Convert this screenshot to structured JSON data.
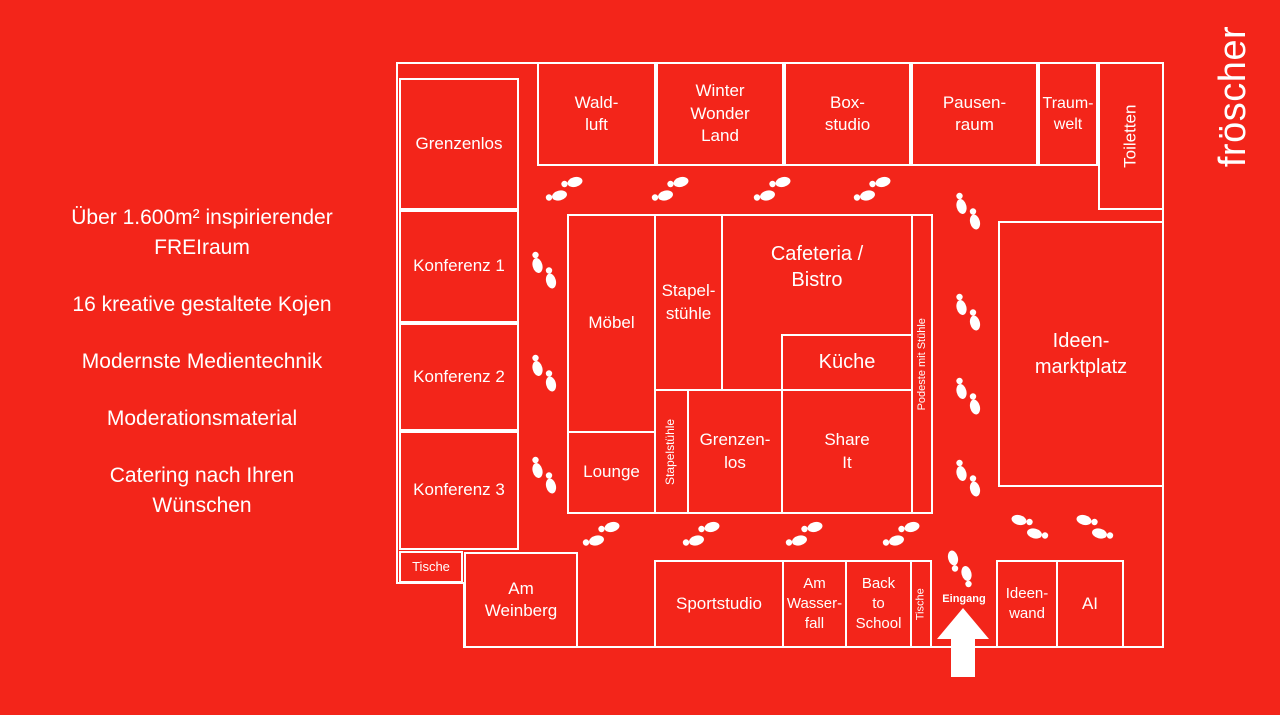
{
  "colors": {
    "background": "#F3251A",
    "line": "#FFFFFF",
    "text": "#FFFFFF"
  },
  "brand": {
    "logo": "fröscher"
  },
  "info_panel": {
    "paragraphs": [
      "Über 1.600m² inspirierender\nFREIraum",
      "16 kreative gestaltete Kojen",
      "Modernste Medientechnik",
      "Moderationsmaterial",
      "Catering nach Ihren\nWünschen"
    ]
  },
  "floorplan": {
    "entrance_label": "Eingang",
    "rooms": [
      {
        "id": "waldluft",
        "label": "Wald-\nluft"
      },
      {
        "id": "winterwonderland",
        "label": "Winter\nWonder\nLand"
      },
      {
        "id": "boxstudio",
        "label": "Box-\nstudio"
      },
      {
        "id": "pausenraum",
        "label": "Pausen-\nraum"
      },
      {
        "id": "traumwelt",
        "label": "Traum-\nwelt"
      },
      {
        "id": "toiletten",
        "label": "Toiletten"
      },
      {
        "id": "grenzenlos1",
        "label": "Grenzenlos"
      },
      {
        "id": "konferenz1",
        "label": "Konferenz 1"
      },
      {
        "id": "konferenz2",
        "label": "Konferenz 2"
      },
      {
        "id": "konferenz3",
        "label": "Konferenz 3"
      },
      {
        "id": "tische1",
        "label": "Tische"
      },
      {
        "id": "moebel",
        "label": "Möbel"
      },
      {
        "id": "lounge",
        "label": "Lounge"
      },
      {
        "id": "stapelstuehle1",
        "label": "Stapel-\nstühle"
      },
      {
        "id": "cafeteria",
        "label": "Cafeteria /\nBistro"
      },
      {
        "id": "kueche",
        "label": "Küche"
      },
      {
        "id": "stapelstuehle2",
        "label": "Stapelstühle"
      },
      {
        "id": "grenzenlos2",
        "label": "Grenzen-\nlos"
      },
      {
        "id": "shareit",
        "label": "Share\nIt"
      },
      {
        "id": "podeste",
        "label": "Podeste mit Stühle"
      },
      {
        "id": "ideenmarktplatz",
        "label": "Ideen-\nmarktplatz"
      },
      {
        "id": "amweinberg",
        "label": "Am\nWeinberg"
      },
      {
        "id": "sportstudio",
        "label": "Sportstudio"
      },
      {
        "id": "amwasserfall",
        "label": "Am\nWasser-\nfall"
      },
      {
        "id": "backtoschool",
        "label": "Back\nto\nSchool"
      },
      {
        "id": "tische2",
        "label": "Tische"
      },
      {
        "id": "ideenwand",
        "label": "Ideen-\nwand"
      },
      {
        "id": "ai",
        "label": "AI"
      }
    ],
    "footprints": [
      {
        "x": 563,
        "y": 190,
        "dir": "right"
      },
      {
        "x": 669,
        "y": 190,
        "dir": "right"
      },
      {
        "x": 771,
        "y": 190,
        "dir": "right"
      },
      {
        "x": 871,
        "y": 190,
        "dir": "right"
      },
      {
        "x": 543,
        "y": 269,
        "dir": "down"
      },
      {
        "x": 543,
        "y": 372,
        "dir": "down"
      },
      {
        "x": 543,
        "y": 474,
        "dir": "down"
      },
      {
        "x": 967,
        "y": 210,
        "dir": "down"
      },
      {
        "x": 967,
        "y": 311,
        "dir": "down"
      },
      {
        "x": 967,
        "y": 395,
        "dir": "down"
      },
      {
        "x": 967,
        "y": 477,
        "dir": "down"
      },
      {
        "x": 600,
        "y": 535,
        "dir": "right"
      },
      {
        "x": 700,
        "y": 535,
        "dir": "right"
      },
      {
        "x": 803,
        "y": 535,
        "dir": "right"
      },
      {
        "x": 900,
        "y": 535,
        "dir": "right"
      },
      {
        "x": 1031,
        "y": 528,
        "dir": "left"
      },
      {
        "x": 1096,
        "y": 528,
        "dir": "left"
      },
      {
        "x": 961,
        "y": 570,
        "dir": "up"
      }
    ]
  }
}
